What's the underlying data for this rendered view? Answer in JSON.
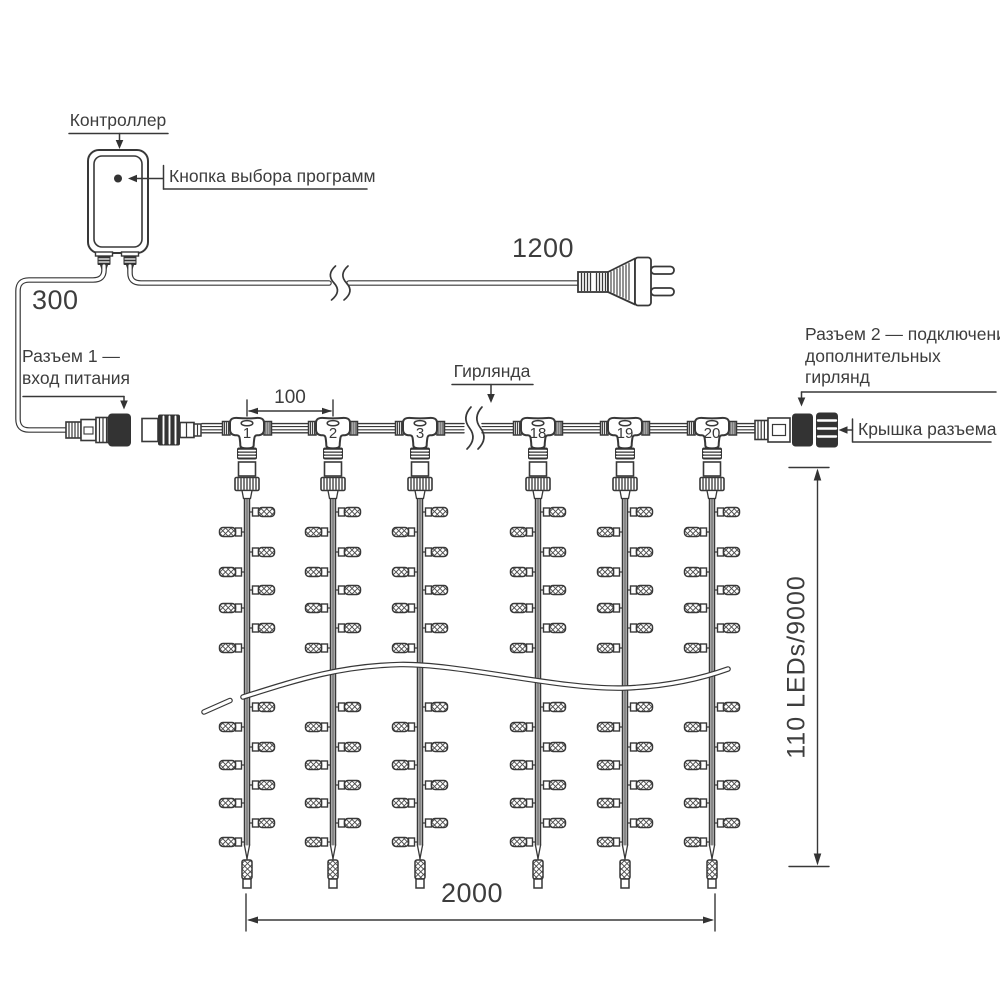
{
  "diagram": {
    "controller_label": "Контроллер",
    "program_button_label": "Кнопка выбора программ",
    "garland_label": "Гирлянда",
    "connector1_label_line1": "Разъем 1 —",
    "connector1_label_line2": "вход питания",
    "connector2_label_line1": "Разъем 2 — подключение",
    "connector2_label_line2": "дополнительных",
    "connector2_label_line3": "гирлянд",
    "cap_label": "Крышка разъема",
    "dim_lead_in": "300",
    "dim_power_cord": "1200",
    "dim_drop_spacing": "100",
    "dim_curtain_width": "2000",
    "dim_curtain_height": "110 LEDs/9000",
    "junction_labels": [
      "1",
      "2",
      "3",
      "18",
      "19",
      "20"
    ]
  },
  "geometry": {
    "junction_x": [
      247,
      333,
      420,
      538,
      625,
      712
    ],
    "led_row_y": [
      512,
      532,
      552,
      572,
      590,
      608,
      628,
      648,
      707,
      727,
      747,
      765,
      785,
      803,
      823,
      842
    ],
    "first_led_side": "right",
    "cable_segments": [
      [
        202,
        223
      ],
      [
        271,
        309
      ],
      [
        357,
        396
      ],
      [
        444,
        464
      ],
      [
        482,
        514
      ],
      [
        562,
        601
      ],
      [
        649,
        688
      ],
      [
        736,
        755
      ]
    ]
  },
  "colors": {
    "line": "#383838",
    "dark_fill": "#333333",
    "text": "#3d3d3d",
    "background": "#ffffff"
  }
}
